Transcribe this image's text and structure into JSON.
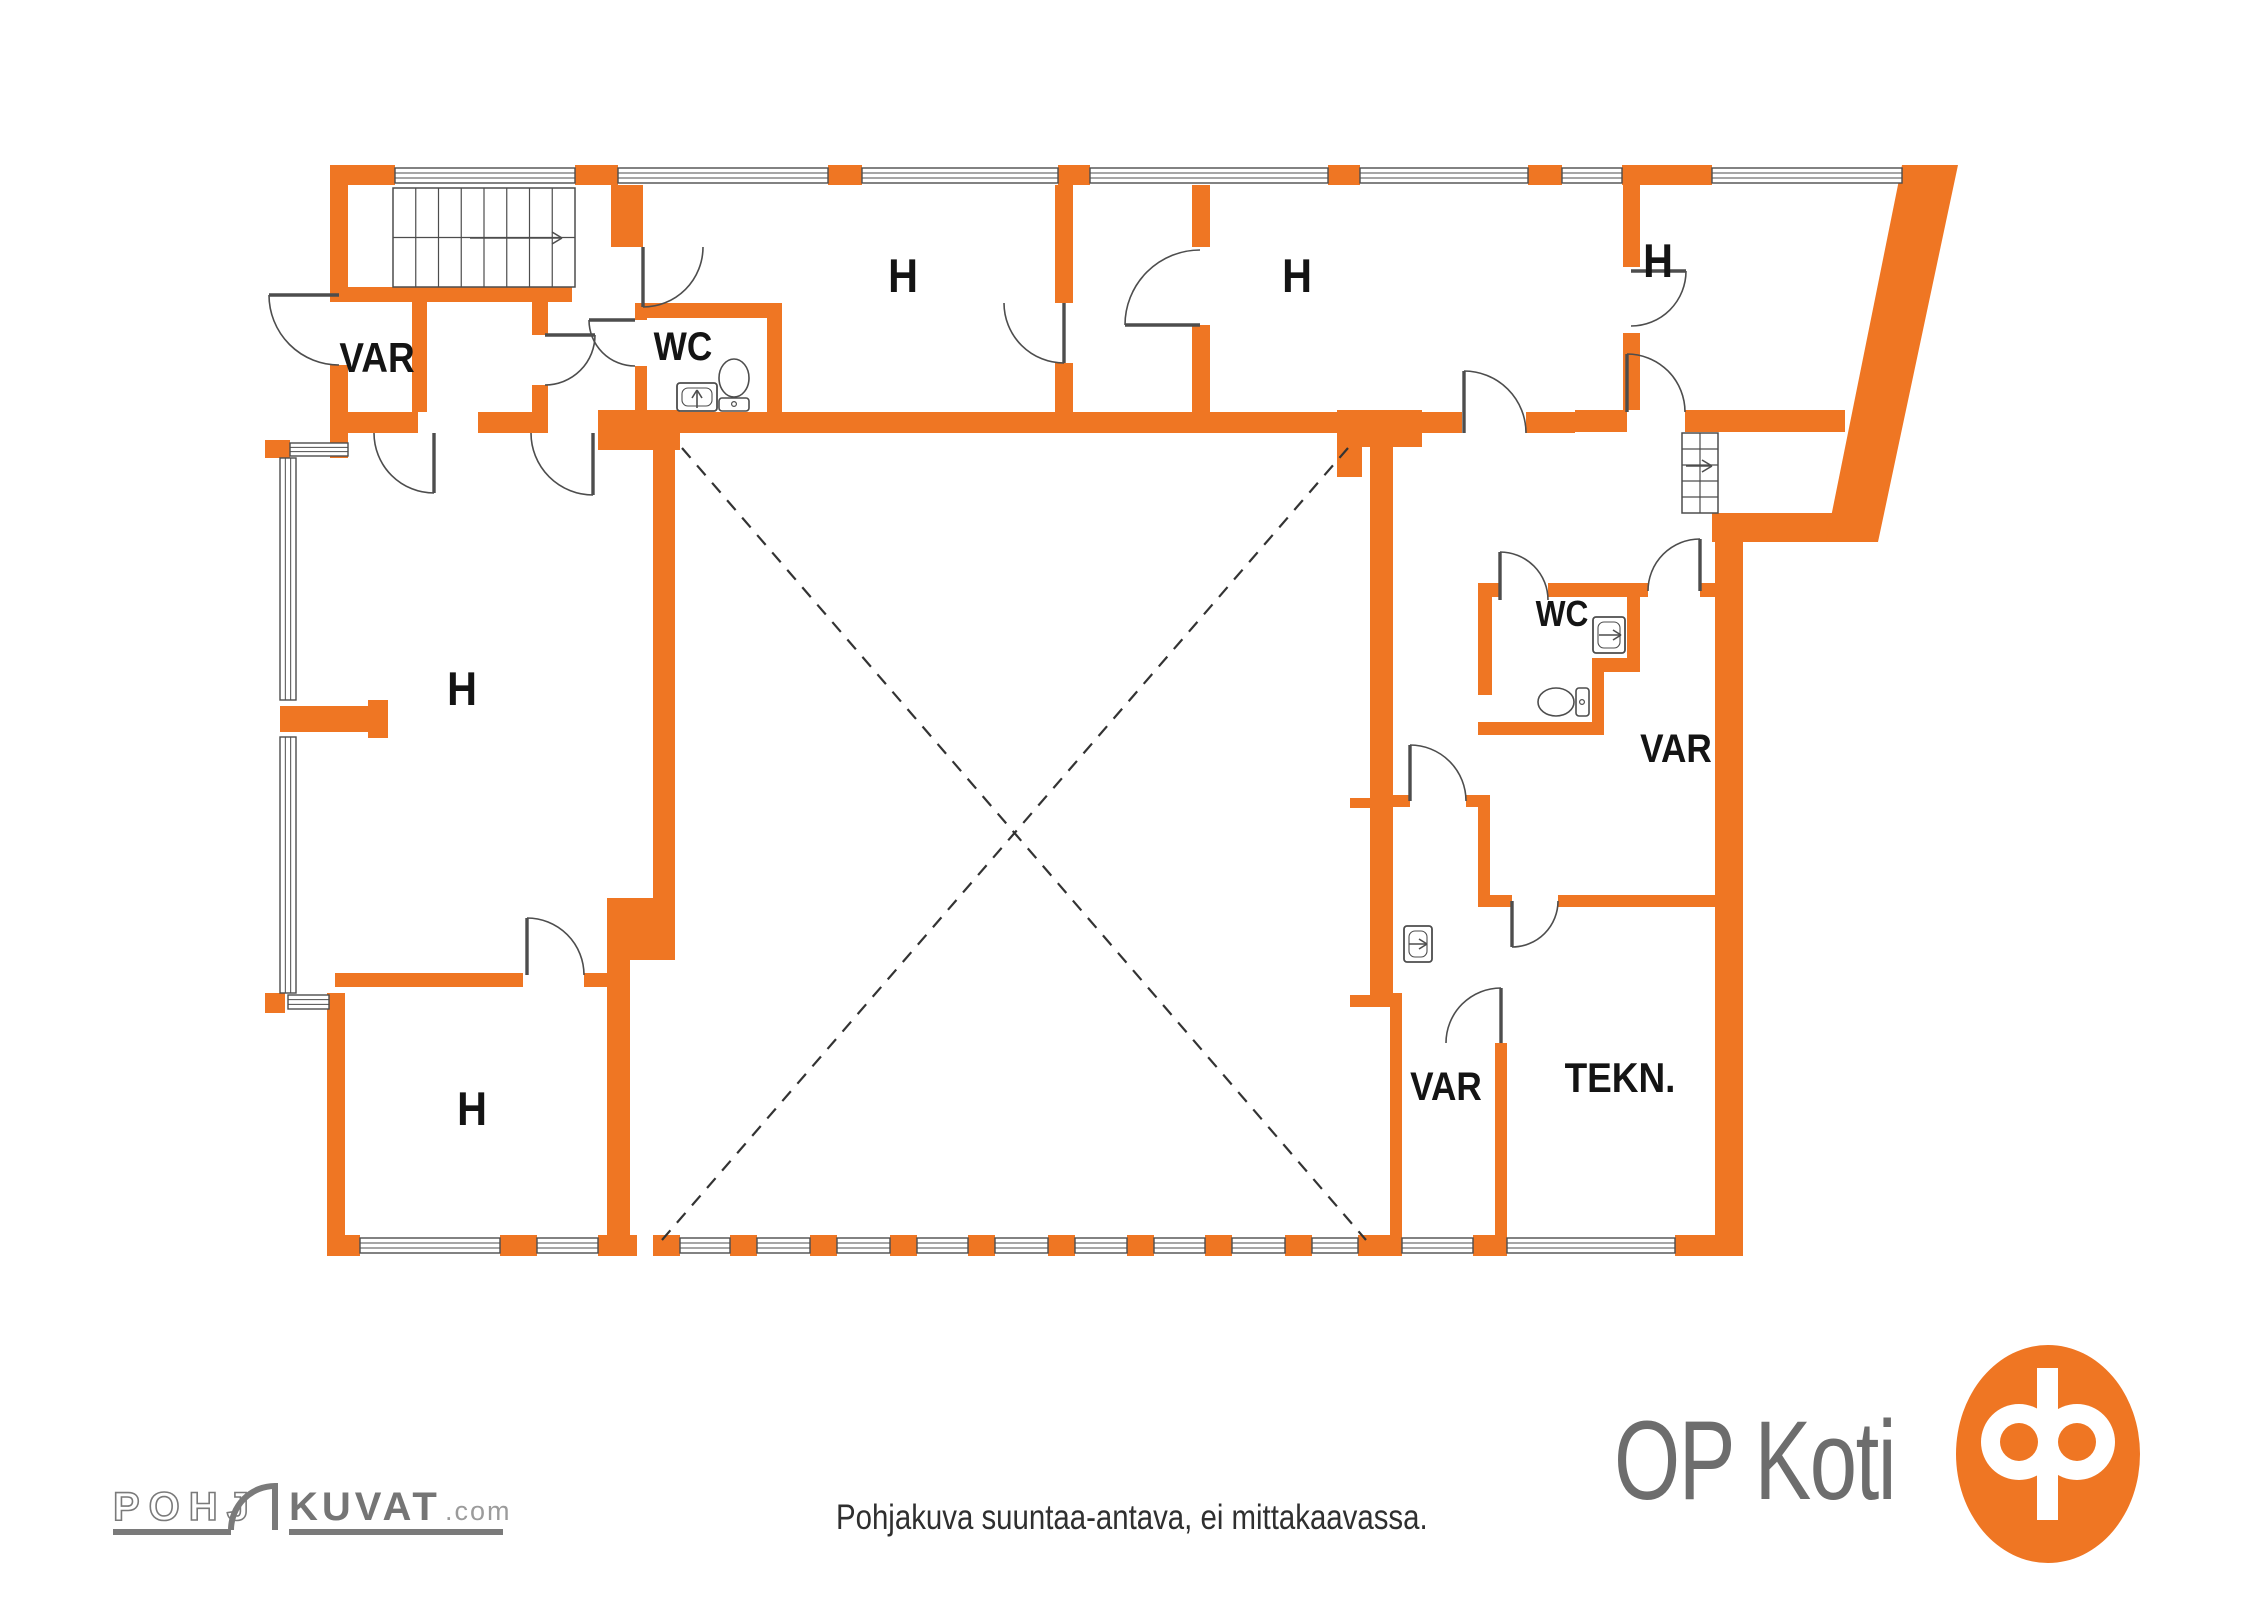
{
  "title": "Floor plan",
  "palette": {
    "wall_orange": "#EF7623",
    "line_gray": "#4d4d4d",
    "label_black": "#141414",
    "logo_gray": "#6d6d6d",
    "brand_gray": "#757575",
    "brand_light_gray": "#9b9b9b",
    "bg": "#ffffff"
  },
  "footer": {
    "disclaimer": "Pohjakuva suuntaa-antava, ei mittakaavassa.",
    "op_logo_text": "OP Koti",
    "brand": {
      "part1": "POHJ",
      "part2": "KUVAT",
      "suffix": ".com"
    }
  },
  "plan": {
    "room_labels": [
      {
        "t": "VAR",
        "x": 377,
        "y": 372,
        "s": 42
      },
      {
        "t": "WC",
        "x": 683,
        "y": 360,
        "s": 40
      },
      {
        "t": "H",
        "x": 903,
        "y": 292,
        "s": 47
      },
      {
        "t": "H",
        "x": 1297,
        "y": 292,
        "s": 47
      },
      {
        "t": "H",
        "x": 1658,
        "y": 277,
        "s": 47
      },
      {
        "t": "H",
        "x": 462,
        "y": 705,
        "s": 47
      },
      {
        "t": "WC",
        "x": 1562,
        "y": 626,
        "s": 36
      },
      {
        "t": "VAR",
        "x": 1676,
        "y": 762,
        "s": 40
      },
      {
        "t": "H",
        "x": 472,
        "y": 1125,
        "s": 47
      },
      {
        "t": "VAR",
        "x": 1446,
        "y": 1100,
        "s": 40
      },
      {
        "t": "TEKN.",
        "x": 1620,
        "y": 1092,
        "s": 42
      }
    ],
    "walls": [
      [
        330,
        165,
        65,
        20
      ],
      [
        330,
        165,
        18,
        130
      ],
      [
        330,
        365,
        18,
        93
      ],
      [
        265,
        440,
        25,
        18
      ],
      [
        330,
        287,
        242,
        15
      ],
      [
        412,
        302,
        15,
        110
      ],
      [
        330,
        412,
        88,
        21
      ],
      [
        478,
        412,
        60,
        21
      ],
      [
        532,
        287,
        16,
        48
      ],
      [
        532,
        385,
        16,
        48
      ],
      [
        611,
        185,
        32,
        62
      ],
      [
        635,
        303,
        147,
        15
      ],
      [
        635,
        303,
        12,
        17
      ],
      [
        635,
        366,
        12,
        46
      ],
      [
        767,
        303,
        15,
        130
      ],
      [
        598,
        410,
        82,
        40
      ],
      [
        680,
        412,
        657,
        21
      ],
      [
        1337,
        410,
        85,
        37
      ],
      [
        1337,
        447,
        25,
        30
      ],
      [
        1422,
        412,
        40,
        21
      ],
      [
        1526,
        412,
        49,
        21
      ],
      [
        1575,
        410,
        52,
        22
      ],
      [
        1685,
        410,
        160,
        22
      ],
      [
        1055,
        185,
        18,
        118
      ],
      [
        1055,
        363,
        18,
        49
      ],
      [
        1192,
        185,
        18,
        62
      ],
      [
        1192,
        325,
        18,
        87
      ],
      [
        1623,
        185,
        17,
        82
      ],
      [
        1623,
        333,
        17,
        77
      ],
      [
        1712,
        513,
        148,
        29
      ],
      [
        1715,
        542,
        28,
        693
      ],
      [
        1675,
        1235,
        68,
        21
      ],
      [
        653,
        412,
        22,
        488
      ],
      [
        607,
        898,
        68,
        62
      ],
      [
        607,
        960,
        23,
        275
      ],
      [
        327,
        993,
        18,
        262
      ],
      [
        265,
        993,
        20,
        20
      ],
      [
        335,
        973,
        188,
        14
      ],
      [
        584,
        973,
        23,
        14
      ],
      [
        280,
        706,
        88,
        26
      ],
      [
        368,
        700,
        20,
        38
      ],
      [
        1370,
        443,
        23,
        552
      ],
      [
        1350,
        798,
        22,
        10
      ],
      [
        1350,
        995,
        52,
        12
      ],
      [
        1390,
        993,
        12,
        245
      ],
      [
        1393,
        795,
        17,
        12
      ],
      [
        1466,
        795,
        24,
        12
      ],
      [
        1478,
        795,
        12,
        100
      ],
      [
        1478,
        895,
        34,
        12
      ],
      [
        1558,
        895,
        157,
        12
      ],
      [
        1495,
        1043,
        12,
        192
      ],
      [
        1478,
        583,
        22,
        14
      ],
      [
        1548,
        583,
        100,
        14
      ],
      [
        1700,
        583,
        15,
        14
      ],
      [
        1478,
        583,
        14,
        112
      ],
      [
        1627,
        583,
        13,
        80
      ],
      [
        1592,
        658,
        48,
        14
      ],
      [
        1592,
        672,
        12,
        62
      ],
      [
        1478,
        722,
        126,
        13
      ],
      [
        327,
        1235,
        33,
        21
      ],
      [
        500,
        1235,
        37,
        21
      ],
      [
        598,
        1235,
        39,
        21
      ],
      [
        653,
        1235,
        27,
        21
      ],
      [
        730,
        1235,
        27,
        21
      ],
      [
        810,
        1235,
        27,
        21
      ],
      [
        890,
        1235,
        27,
        21
      ],
      [
        968,
        1235,
        27,
        21
      ],
      [
        1048,
        1235,
        27,
        21
      ],
      [
        1127,
        1235,
        27,
        21
      ],
      [
        1205,
        1235,
        27,
        21
      ],
      [
        1285,
        1235,
        27,
        21
      ],
      [
        1358,
        1235,
        44,
        21
      ],
      [
        1473,
        1235,
        34,
        21
      ],
      [
        575,
        165,
        43,
        20
      ],
      [
        828,
        165,
        34,
        20
      ],
      [
        1058,
        165,
        32,
        20
      ],
      [
        1328,
        165,
        32,
        20
      ],
      [
        1528,
        165,
        34,
        20
      ],
      [
        1622,
        165,
        90,
        20
      ]
    ],
    "slant_polygons": [
      [
        [
          1902,
          165
        ],
        [
          1958,
          165
        ],
        [
          1878,
          542
        ],
        [
          1826,
          542
        ]
      ]
    ],
    "windows": [
      [
        395,
        168,
        180,
        15
      ],
      [
        618,
        168,
        210,
        15
      ],
      [
        862,
        168,
        196,
        15
      ],
      [
        1090,
        168,
        238,
        15
      ],
      [
        1360,
        168,
        168,
        15
      ],
      [
        1562,
        168,
        60,
        15
      ],
      [
        1712,
        168,
        190,
        15
      ],
      [
        280,
        458,
        16,
        242
      ],
      [
        280,
        737,
        16,
        256
      ],
      [
        288,
        995,
        41,
        14
      ],
      [
        290,
        443,
        58,
        13
      ],
      [
        360,
        1238,
        140,
        15
      ],
      [
        537,
        1238,
        61,
        15
      ],
      [
        680,
        1238,
        50,
        15
      ],
      [
        757,
        1238,
        53,
        15
      ],
      [
        837,
        1238,
        53,
        15
      ],
      [
        917,
        1238,
        51,
        15
      ],
      [
        995,
        1238,
        53,
        15
      ],
      [
        1075,
        1238,
        52,
        15
      ],
      [
        1154,
        1238,
        51,
        15
      ],
      [
        1232,
        1238,
        53,
        15
      ],
      [
        1312,
        1238,
        46,
        15
      ],
      [
        1402,
        1238,
        71,
        15
      ],
      [
        1507,
        1238,
        168,
        15
      ]
    ],
    "doors": [
      [
        545,
        335,
        50,
        0,
        90
      ],
      [
        643,
        247,
        60,
        90,
        0
      ],
      [
        635,
        320,
        46,
        180,
        90
      ],
      [
        1064,
        303,
        60,
        90,
        180
      ],
      [
        1464,
        433,
        62,
        270,
        360
      ],
      [
        1631,
        271,
        55,
        0,
        90
      ],
      [
        1627,
        412,
        58,
        270,
        360
      ],
      [
        1200,
        325,
        75,
        180,
        270
      ],
      [
        1500,
        600,
        48,
        270,
        360
      ],
      [
        1700,
        591,
        52,
        270,
        180
      ],
      [
        1410,
        801,
        56,
        270,
        360
      ],
      [
        1512,
        901,
        46,
        90,
        0
      ],
      [
        1501,
        1043,
        55,
        270,
        180
      ],
      [
        434,
        433,
        60,
        90,
        180
      ],
      [
        527,
        975,
        57,
        270,
        360
      ],
      [
        593,
        433,
        62,
        90,
        180
      ],
      [
        339,
        295,
        70,
        180,
        90
      ]
    ],
    "stairs": [
      {
        "x": 393,
        "y": 188,
        "w": 182,
        "h": 99,
        "dir": "h",
        "risers": 8,
        "mid": true,
        "arrow": [
          470,
          238,
          562,
          238
        ]
      },
      {
        "x": 1682,
        "y": 433,
        "w": 36,
        "h": 80,
        "dir": "v",
        "risers": 5,
        "mid": true,
        "arrow": [
          1686,
          466,
          1712,
          466
        ]
      }
    ],
    "fixtures": {
      "toilets": [
        {
          "bx": 734,
          "by": 378,
          "rx": 15,
          "ry": 19,
          "tank": [
            719,
            398,
            30,
            13
          ],
          "knob": [
            734,
            404
          ]
        },
        {
          "bx": 1556,
          "by": 702,
          "rx": 18,
          "ry": 14,
          "tank": [
            1576,
            688,
            13,
            28
          ],
          "knob": [
            1582,
            702
          ]
        }
      ],
      "sinks": [
        {
          "r": [
            677,
            383,
            40,
            28
          ],
          "arrow": [
            697,
            408,
            697,
            390
          ]
        },
        {
          "r": [
            1593,
            617,
            32,
            36
          ],
          "arrow": [
            1599,
            635,
            1621,
            635
          ]
        },
        {
          "r": [
            1404,
            926,
            28,
            36
          ],
          "arrow": [
            1409,
            944,
            1427,
            944
          ]
        }
      ]
    },
    "dashed_lines": [
      [
        682,
        448,
        1366,
        1240
      ],
      [
        1348,
        448,
        662,
        1240
      ]
    ]
  }
}
